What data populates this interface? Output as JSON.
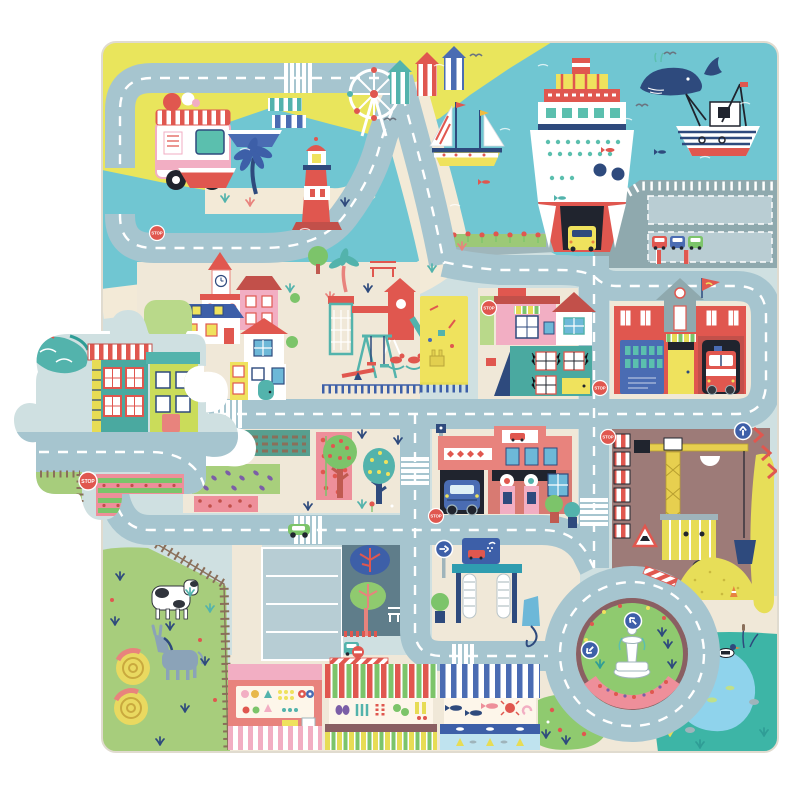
{
  "signs": {
    "stop": "STOP"
  },
  "palette": {
    "page_bg": "#ffffff",
    "mat_base": "#cfe0e1",
    "road": "#a6c5cf",
    "road_line": "#ffffff",
    "sand_yellow": "#e9e55c",
    "sea": "#70c6d2",
    "beach": "#f3ead7",
    "cream": "#f0e8d8",
    "farm_green": "#a7cd7c",
    "park_green": "#8fca6f",
    "slate": "#5f7d8a",
    "parking": "#b7cdd4",
    "pier_gray": "#8fa9ae",
    "construction_brown": "#9d7b78",
    "sand_pile": "#e7de58",
    "pond_teal": "#3db5a6",
    "pond_water": "#8fd3ec",
    "red": "#e0574f",
    "coral": "#e8837d",
    "pink": "#f2aec3",
    "rose": "#ee8f9a",
    "maroon": "#8a5f63",
    "navy": "#2e4a7d",
    "blue": "#4a6cb3",
    "sky_blue": "#6db8d8",
    "teal": "#53b3ac",
    "yellow": "#efe25d",
    "lime": "#cadc5a",
    "dark": "#20242e",
    "brown": "#8a6f5a",
    "red_roof": "#c2504a",
    "orange": "#e8833f"
  },
  "objects": [
    "ice-cream-truck",
    "rowing-boats",
    "palm-tree",
    "lighthouse",
    "ferris-wheel",
    "beach-huts",
    "sailboat",
    "ferry-ship",
    "whale",
    "fishing-boat",
    "seagulls",
    "harbor-pier",
    "port-parking",
    "town-houses",
    "church",
    "playground",
    "sandbox",
    "fire-station",
    "fire-truck",
    "gas-station",
    "car-wash",
    "parking-lot",
    "construction-site",
    "crane",
    "roundabout-fountain",
    "farm",
    "cow",
    "donkey",
    "hay-bales",
    "vegetable-gardens",
    "market-stalls",
    "flower-garden",
    "duck-pond",
    "detached-puzzle-piece",
    "missing-piece-hole",
    "stop-signs",
    "crosswalks",
    "arrow-signs"
  ]
}
